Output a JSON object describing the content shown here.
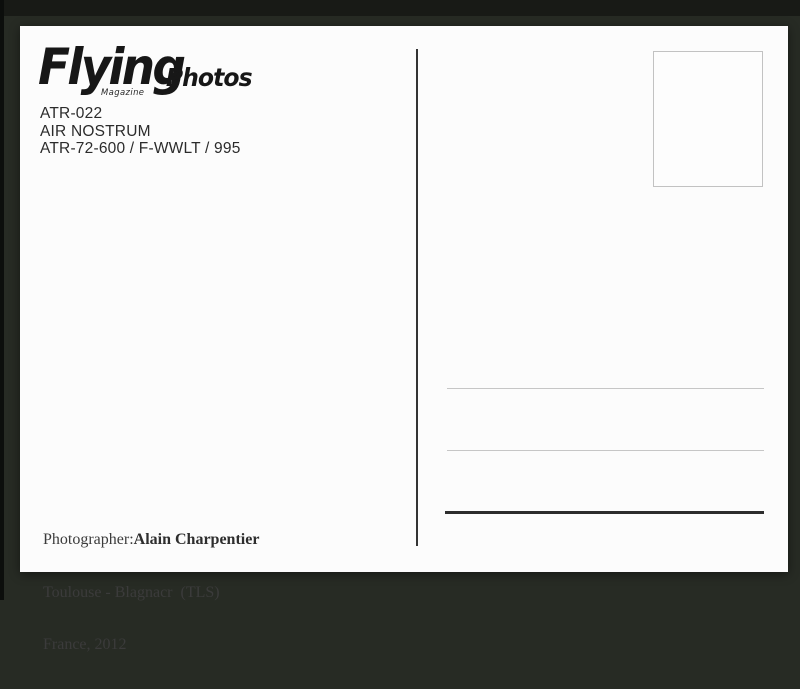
{
  "postcard": {
    "logo": {
      "brand": "Flying",
      "brand_suffix": "Photos",
      "tagline": "Magazine"
    },
    "photo_info": {
      "reference": "ATR-022",
      "airline": "AIR NOSTRUM",
      "aircraft_registration": "ATR-72-600 / F-WWLT / 995"
    },
    "credits": {
      "photographer_label": "Photographer:",
      "photographer_name": "Alain Charpentier",
      "location": "Toulouse - Blagnacr  (TLS)",
      "date": "France, 2012"
    },
    "colors": {
      "backdrop": "#272b24",
      "card": "#fcfcfc",
      "ink": "#2b2b2b",
      "divider": "#343434",
      "light_line": "#c6c6c6",
      "stamp_border": "#c2c2c2"
    }
  }
}
